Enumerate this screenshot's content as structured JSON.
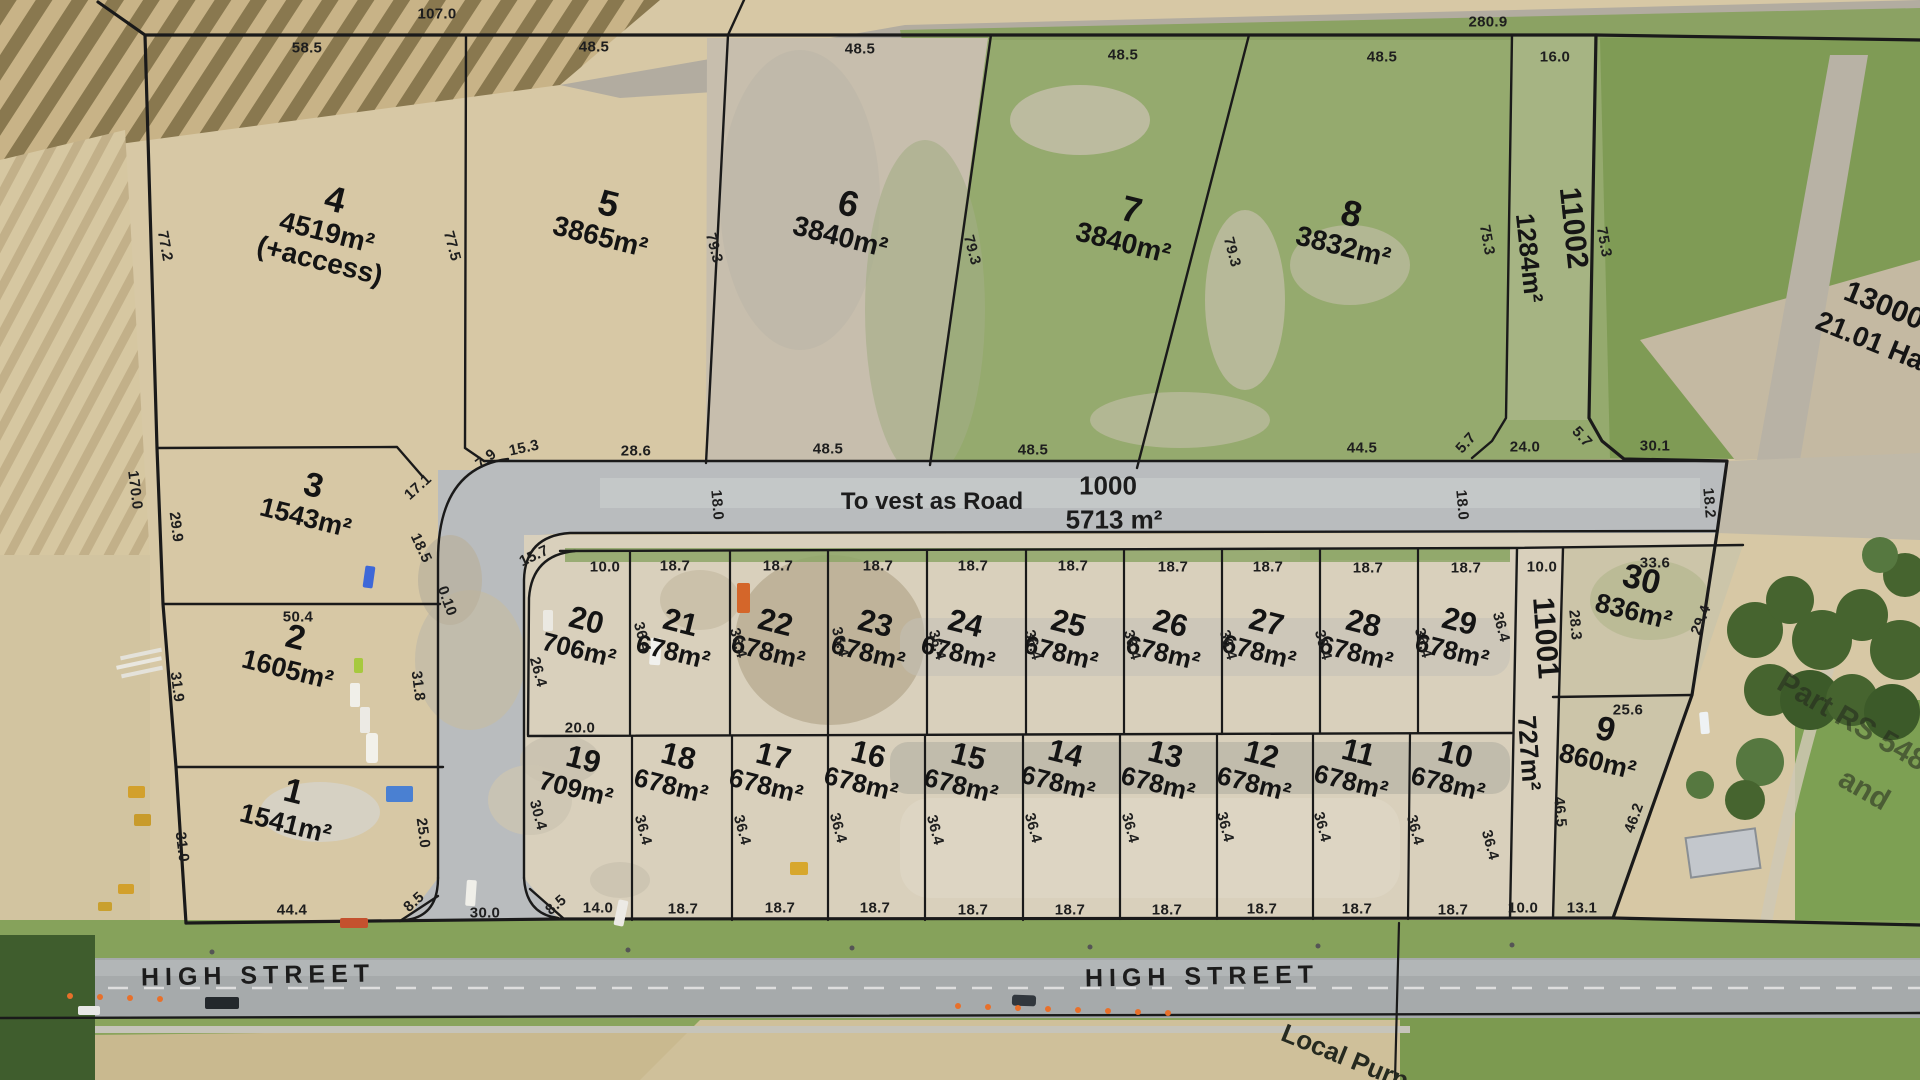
{
  "map": {
    "road_label": "To vest as Road",
    "road_lot_number": "1000",
    "road_lot_area": "5713 m²",
    "street_name_left": "HIGH STREET",
    "street_name_right": "HIGH STREET",
    "local_purpose_label": "Local Purp",
    "part_rs_label": "Part RS 548",
    "part_rs_label_2": "and"
  },
  "colors": {
    "boundary_line": "#1a1a1a",
    "road_surface": "#b9bcbe",
    "field_tan": "#d7c8a5",
    "field_green": "#95aa6e",
    "street_surface": "#a6aaab"
  },
  "lots": [
    {
      "number": "1",
      "area": "1541m²",
      "x": 290,
      "y": 806,
      "rot": 14,
      "nfs": 34,
      "afs": 27
    },
    {
      "number": "2",
      "area": "1605m²",
      "x": 292,
      "y": 652,
      "rot": 14,
      "nfs": 34,
      "afs": 27
    },
    {
      "number": "3",
      "area": "1543m²",
      "x": 310,
      "y": 500,
      "rot": 14,
      "nfs": 34,
      "afs": 27
    },
    {
      "number": "4",
      "area": "4519m²",
      "extra": "(+access)",
      "x": 328,
      "y": 228,
      "rot": 14,
      "nfs": 36,
      "afs": 28
    },
    {
      "number": "5",
      "area": "3865m²",
      "x": 605,
      "y": 218,
      "rot": 14,
      "nfs": 36,
      "afs": 28
    },
    {
      "number": "6",
      "area": "3840m²",
      "x": 845,
      "y": 218,
      "rot": 14,
      "nfs": 36,
      "afs": 28
    },
    {
      "number": "7",
      "area": "3840m²",
      "x": 1128,
      "y": 224,
      "rot": 14,
      "nfs": 36,
      "afs": 28
    },
    {
      "number": "8",
      "area": "3832m²",
      "x": 1348,
      "y": 228,
      "rot": 14,
      "nfs": 36,
      "afs": 28
    },
    {
      "number": "9",
      "area": "860m²",
      "x": 1602,
      "y": 744,
      "rot": 14,
      "nfs": 34,
      "afs": 27
    },
    {
      "number": "10",
      "area": "678m²",
      "x": 1452,
      "y": 768,
      "rot": 14,
      "nfs": 31,
      "afs": 26
    },
    {
      "number": "11",
      "area": "678m²",
      "x": 1355,
      "y": 766,
      "rot": 14,
      "nfs": 31,
      "afs": 26
    },
    {
      "number": "12",
      "area": "678m²",
      "x": 1258,
      "y": 768,
      "rot": 14,
      "nfs": 31,
      "afs": 26
    },
    {
      "number": "13",
      "area": "678m²",
      "x": 1162,
      "y": 768,
      "rot": 14,
      "nfs": 31,
      "afs": 26
    },
    {
      "number": "14",
      "area": "678m²",
      "x": 1062,
      "y": 767,
      "rot": 14,
      "nfs": 31,
      "afs": 26
    },
    {
      "number": "15",
      "area": "678m²",
      "x": 965,
      "y": 770,
      "rot": 14,
      "nfs": 31,
      "afs": 26
    },
    {
      "number": "16",
      "area": "678m²",
      "x": 865,
      "y": 768,
      "rot": 14,
      "nfs": 31,
      "afs": 26
    },
    {
      "number": "17",
      "area": "678m²",
      "x": 770,
      "y": 770,
      "rot": 14,
      "nfs": 31,
      "afs": 26
    },
    {
      "number": "18",
      "area": "678m²",
      "x": 675,
      "y": 770,
      "rot": 14,
      "nfs": 31,
      "afs": 26
    },
    {
      "number": "19",
      "area": "709m²",
      "x": 580,
      "y": 773,
      "rot": 14,
      "nfs": 31,
      "afs": 26
    },
    {
      "number": "20",
      "area": "706m²",
      "x": 583,
      "y": 634,
      "rot": 14,
      "nfs": 31,
      "afs": 26
    },
    {
      "number": "21",
      "area": "678m²",
      "x": 677,
      "y": 636,
      "rot": 14,
      "nfs": 31,
      "afs": 26
    },
    {
      "number": "22",
      "area": "678m²",
      "x": 772,
      "y": 636,
      "rot": 14,
      "nfs": 31,
      "afs": 26
    },
    {
      "number": "23",
      "area": "678m²",
      "x": 872,
      "y": 637,
      "rot": 14,
      "nfs": 31,
      "afs": 26
    },
    {
      "number": "24",
      "area": "678m²",
      "x": 962,
      "y": 637,
      "rot": 14,
      "nfs": 31,
      "afs": 26
    },
    {
      "number": "25",
      "area": "678m²",
      "x": 1065,
      "y": 637,
      "rot": 14,
      "nfs": 31,
      "afs": 26
    },
    {
      "number": "26",
      "area": "678m²",
      "x": 1167,
      "y": 637,
      "rot": 14,
      "nfs": 31,
      "afs": 26
    },
    {
      "number": "27",
      "area": "678m²",
      "x": 1263,
      "y": 636,
      "rot": 14,
      "nfs": 31,
      "afs": 26
    },
    {
      "number": "28",
      "area": "678m²",
      "x": 1360,
      "y": 637,
      "rot": 14,
      "nfs": 31,
      "afs": 26
    },
    {
      "number": "29",
      "area": "678m²",
      "x": 1456,
      "y": 635,
      "rot": 14,
      "nfs": 31,
      "afs": 26
    },
    {
      "number": "30",
      "area": "836m²",
      "x": 1638,
      "y": 594,
      "rot": 14,
      "nfs": 34,
      "afs": 27
    }
  ],
  "special_labels": [
    {
      "t": "11002",
      "x": 1573,
      "y": 228,
      "r": 84,
      "fs": 30
    },
    {
      "t": "1284m²",
      "x": 1529,
      "y": 258,
      "r": 84,
      "fs": 26
    },
    {
      "t": "11001",
      "x": 1545,
      "y": 638,
      "r": 86,
      "fs": 30
    },
    {
      "t": "727m²",
      "x": 1529,
      "y": 753,
      "r": 86,
      "fs": 26
    },
    {
      "t": "13000",
      "x": 1884,
      "y": 306,
      "r": 22,
      "fs": 30
    },
    {
      "t": "21.01 Ha",
      "x": 1870,
      "y": 341,
      "r": 22,
      "fs": 28
    }
  ],
  "dims": [
    {
      "t": "107.0",
      "x": 437,
      "y": 14,
      "r": 0
    },
    {
      "t": "280.9",
      "x": 1488,
      "y": 22,
      "r": 0
    },
    {
      "t": "58.5",
      "x": 307,
      "y": 48,
      "r": 0
    },
    {
      "t": "48.5",
      "x": 594,
      "y": 47,
      "r": 0
    },
    {
      "t": "48.5",
      "x": 860,
      "y": 49,
      "r": 0
    },
    {
      "t": "48.5",
      "x": 1123,
      "y": 55,
      "r": 0
    },
    {
      "t": "48.5",
      "x": 1382,
      "y": 57,
      "r": 0
    },
    {
      "t": "16.0",
      "x": 1555,
      "y": 57,
      "r": 0
    },
    {
      "t": "77.2",
      "x": 165,
      "y": 246,
      "r": 80
    },
    {
      "t": "77.5",
      "x": 452,
      "y": 246,
      "r": 75
    },
    {
      "t": "79.3",
      "x": 714,
      "y": 248,
      "r": 75
    },
    {
      "t": "79.3",
      "x": 972,
      "y": 250,
      "r": 75
    },
    {
      "t": "79.3",
      "x": 1232,
      "y": 252,
      "r": 75
    },
    {
      "t": "75.3",
      "x": 1487,
      "y": 240,
      "r": 80
    },
    {
      "t": "75.3",
      "x": 1604,
      "y": 242,
      "r": 80
    },
    {
      "t": "170.0",
      "x": 135,
      "y": 490,
      "r": 83
    },
    {
      "t": "29.9",
      "x": 176,
      "y": 527,
      "r": 83
    },
    {
      "t": "17.1",
      "x": 418,
      "y": 487,
      "r": -42
    },
    {
      "t": "18.5",
      "x": 421,
      "y": 548,
      "r": 65
    },
    {
      "t": "7.9",
      "x": 486,
      "y": 459,
      "r": -38
    },
    {
      "t": "15.3",
      "x": 524,
      "y": 448,
      "r": -12
    },
    {
      "t": "28.6",
      "x": 636,
      "y": 451,
      "r": 0
    },
    {
      "t": "48.5",
      "x": 828,
      "y": 449,
      "r": 0
    },
    {
      "t": "48.5",
      "x": 1033,
      "y": 450,
      "r": 0
    },
    {
      "t": "44.5",
      "x": 1362,
      "y": 448,
      "r": 0
    },
    {
      "t": "5.7",
      "x": 1466,
      "y": 443,
      "r": -48
    },
    {
      "t": "24.0",
      "x": 1525,
      "y": 447,
      "r": 0
    },
    {
      "t": "5.7",
      "x": 1582,
      "y": 437,
      "r": 48
    },
    {
      "t": "30.1",
      "x": 1655,
      "y": 446,
      "r": 0
    },
    {
      "t": "18.0",
      "x": 717,
      "y": 505,
      "r": 85
    },
    {
      "t": "18.0",
      "x": 1462,
      "y": 505,
      "r": 85
    },
    {
      "t": "18.2",
      "x": 1709,
      "y": 503,
      "r": 85
    },
    {
      "t": "50.4",
      "x": 298,
      "y": 617,
      "r": 0
    },
    {
      "t": "31.9",
      "x": 177,
      "y": 687,
      "r": 83
    },
    {
      "t": "31.8",
      "x": 418,
      "y": 686,
      "r": 83
    },
    {
      "t": "31.0",
      "x": 182,
      "y": 847,
      "r": 83
    },
    {
      "t": "25.0",
      "x": 423,
      "y": 833,
      "r": 83
    },
    {
      "t": "44.4",
      "x": 292,
      "y": 910,
      "r": 0
    },
    {
      "t": "8.5",
      "x": 414,
      "y": 902,
      "r": -42
    },
    {
      "t": "30.0",
      "x": 485,
      "y": 913,
      "r": 0
    },
    {
      "t": "0.10",
      "x": 447,
      "y": 601,
      "r": 70
    },
    {
      "t": "15.7",
      "x": 534,
      "y": 556,
      "r": -25
    },
    {
      "t": "10.0",
      "x": 605,
      "y": 567,
      "r": 0
    },
    {
      "t": "18.7",
      "x": 675,
      "y": 566,
      "r": 0
    },
    {
      "t": "18.7",
      "x": 778,
      "y": 566,
      "r": 0
    },
    {
      "t": "18.7",
      "x": 878,
      "y": 566,
      "r": 0
    },
    {
      "t": "18.7",
      "x": 973,
      "y": 566,
      "r": 0
    },
    {
      "t": "18.7",
      "x": 1073,
      "y": 566,
      "r": 0
    },
    {
      "t": "18.7",
      "x": 1173,
      "y": 567,
      "r": 0
    },
    {
      "t": "18.7",
      "x": 1268,
      "y": 567,
      "r": 0
    },
    {
      "t": "18.7",
      "x": 1368,
      "y": 568,
      "r": 0
    },
    {
      "t": "18.7",
      "x": 1466,
      "y": 568,
      "r": 0
    },
    {
      "t": "10.0",
      "x": 1542,
      "y": 567,
      "r": 0
    },
    {
      "t": "33.6",
      "x": 1655,
      "y": 563,
      "r": 0
    },
    {
      "t": "26.4",
      "x": 538,
      "y": 672,
      "r": 75
    },
    {
      "t": "36.4",
      "x": 642,
      "y": 637,
      "r": 75
    },
    {
      "t": "36.4",
      "x": 738,
      "y": 643,
      "r": 75
    },
    {
      "t": "36.4",
      "x": 840,
      "y": 642,
      "r": 75
    },
    {
      "t": "36.4",
      "x": 937,
      "y": 645,
      "r": 75
    },
    {
      "t": "36.4",
      "x": 1033,
      "y": 645,
      "r": 75
    },
    {
      "t": "36.4",
      "x": 1132,
      "y": 645,
      "r": 75
    },
    {
      "t": "36.4",
      "x": 1228,
      "y": 645,
      "r": 75
    },
    {
      "t": "36.4",
      "x": 1323,
      "y": 645,
      "r": 75
    },
    {
      "t": "36.4",
      "x": 1423,
      "y": 643,
      "r": 75
    },
    {
      "t": "36.4",
      "x": 1501,
      "y": 627,
      "r": 75
    },
    {
      "t": "29.4",
      "x": 1701,
      "y": 620,
      "r": -68
    },
    {
      "t": "28.3",
      "x": 1575,
      "y": 625,
      "r": 85
    },
    {
      "t": "46.5",
      "x": 1560,
      "y": 812,
      "r": 85
    },
    {
      "t": "25.6",
      "x": 1628,
      "y": 710,
      "r": 0
    },
    {
      "t": "46.2",
      "x": 1634,
      "y": 818,
      "r": -70
    },
    {
      "t": "20.0",
      "x": 580,
      "y": 728,
      "r": 0
    },
    {
      "t": "30.4",
      "x": 538,
      "y": 815,
      "r": 75
    },
    {
      "t": "36.4",
      "x": 643,
      "y": 830,
      "r": 75
    },
    {
      "t": "36.4",
      "x": 742,
      "y": 830,
      "r": 75
    },
    {
      "t": "36.4",
      "x": 838,
      "y": 828,
      "r": 75
    },
    {
      "t": "36.4",
      "x": 935,
      "y": 830,
      "r": 75
    },
    {
      "t": "36.4",
      "x": 1033,
      "y": 828,
      "r": 75
    },
    {
      "t": "36.4",
      "x": 1130,
      "y": 828,
      "r": 75
    },
    {
      "t": "36.4",
      "x": 1225,
      "y": 827,
      "r": 75
    },
    {
      "t": "36.4",
      "x": 1322,
      "y": 827,
      "r": 75
    },
    {
      "t": "36.4",
      "x": 1415,
      "y": 830,
      "r": 75
    },
    {
      "t": "36.4",
      "x": 1490,
      "y": 845,
      "r": 75
    },
    {
      "t": "8.5",
      "x": 556,
      "y": 905,
      "r": -40
    },
    {
      "t": "14.0",
      "x": 598,
      "y": 908,
      "r": 0
    },
    {
      "t": "18.7",
      "x": 683,
      "y": 909,
      "r": 0
    },
    {
      "t": "18.7",
      "x": 780,
      "y": 908,
      "r": 0
    },
    {
      "t": "18.7",
      "x": 875,
      "y": 908,
      "r": 0
    },
    {
      "t": "18.7",
      "x": 973,
      "y": 910,
      "r": 0
    },
    {
      "t": "18.7",
      "x": 1070,
      "y": 910,
      "r": 0
    },
    {
      "t": "18.7",
      "x": 1167,
      "y": 910,
      "r": 0
    },
    {
      "t": "18.7",
      "x": 1262,
      "y": 909,
      "r": 0
    },
    {
      "t": "18.7",
      "x": 1357,
      "y": 909,
      "r": 0
    },
    {
      "t": "18.7",
      "x": 1453,
      "y": 910,
      "r": 0
    },
    {
      "t": "10.0",
      "x": 1523,
      "y": 908,
      "r": 0
    },
    {
      "t": "13.1",
      "x": 1582,
      "y": 908,
      "r": 0
    }
  ]
}
